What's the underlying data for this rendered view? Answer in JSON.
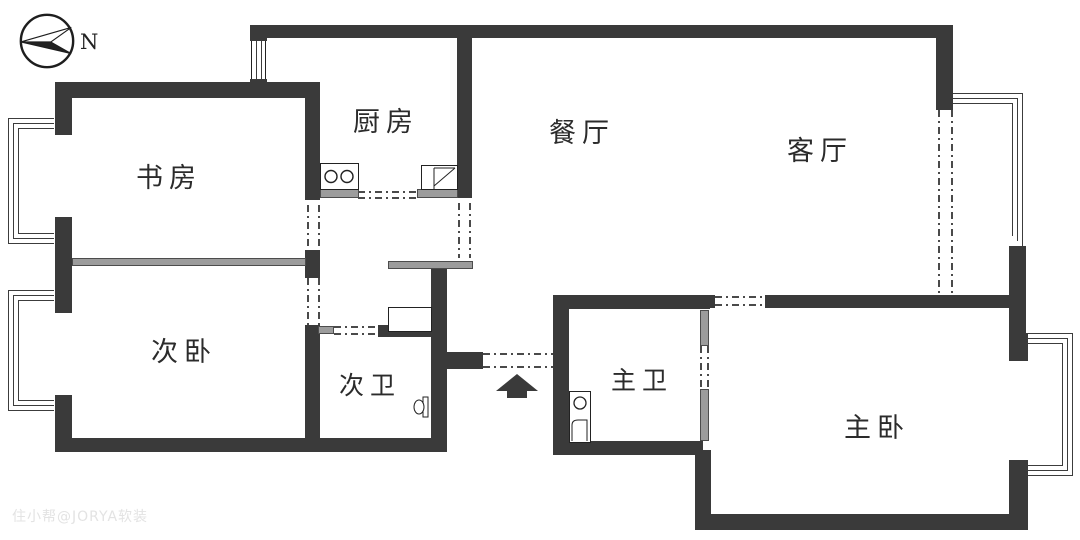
{
  "meta": {
    "compass_label": "N",
    "watermark": "住小帮@JORYA软装"
  },
  "rooms": {
    "study": {
      "label": "书房"
    },
    "kitchen": {
      "label": "厨房"
    },
    "dining": {
      "label": "餐厅"
    },
    "living": {
      "label": "客厅"
    },
    "second_bedroom": {
      "label": "次卧"
    },
    "second_bath": {
      "label": "次卫"
    },
    "master_bath": {
      "label": "主卫"
    },
    "master_bedroom": {
      "label": "主卧"
    }
  },
  "icons": {
    "compass": "north-arrow",
    "entry_arrow": "entrance-direction-up",
    "stove": "two-burner-stove",
    "sink": "kitchen-sink",
    "toilet": "toilet",
    "basin": "washbasin"
  },
  "colors": {
    "wall": "#3a3a3a",
    "light_partition": "#9c9c9c",
    "background": "#ffffff",
    "watermark": "#e3e3e3"
  }
}
